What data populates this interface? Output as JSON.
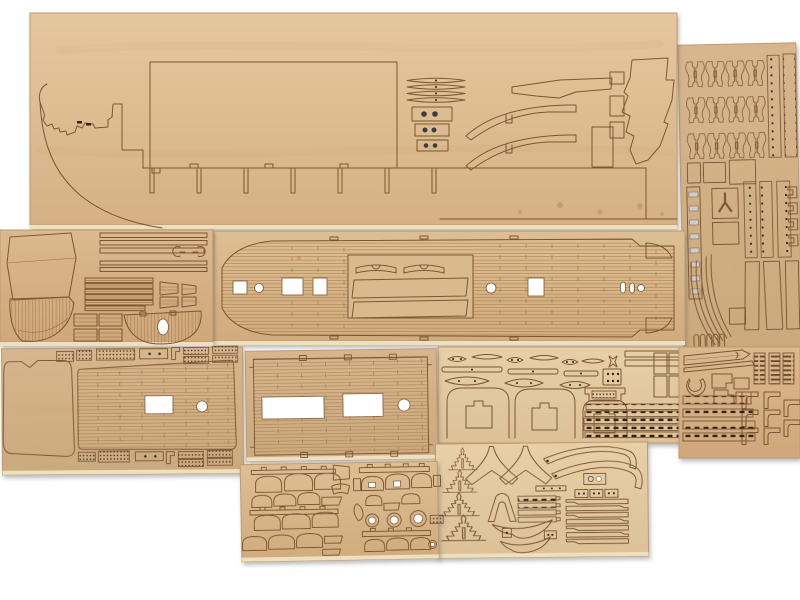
{
  "scene": {
    "title": "Laser-cut wooden model ship kit — plywood part sheets on white background",
    "subject": "photograph of tan plywood sheets with laser-cut and engraved ship parts"
  },
  "colors": {
    "bg": "#ffffff",
    "laser": "#7d5733",
    "laser-soft": "#9b6f3f",
    "plank": "#a57a49",
    "hole": "#30241a",
    "metal": "#c9ced2",
    "metal-dark": "#8e959b",
    "ply-edge": "#eedfbd",
    "sheet-edge": "#bf9a6e",
    "scorch": "#b4552d",
    "wood-flat": "#d9ba8e",
    "w1a": "#e5c79d",
    "w1b": "#d5b185",
    "w2a": "#ddbf93",
    "w2b": "#d0ab7d",
    "w3a": "#dbb88f",
    "w3b": "#cfa77a",
    "w4a": "#d8b68d",
    "w4b": "#cba97e",
    "w5a": "#e7cfa7",
    "w5b": "#dcc197"
  },
  "sheets": [
    {
      "id": "fittings-column",
      "label": "Tall right sheet with three rows of cannon-carriage brackets, drilled strips, eyebolt strip, curved battens and trapezoid parts",
      "carriage_rows": 3,
      "carriages_per_row": 4
    },
    {
      "id": "hull-sides",
      "label": "Large top sheet with hull side profile, stem pieces, large rectangular cutout, bulkhead slots and stern profile parts",
      "bulkhead_slots": 7
    },
    {
      "id": "main-deck",
      "label": "Long planked main deck with mast holes, hatch openings and transom plank panel"
    },
    {
      "id": "stern-parts",
      "label": "Left sheet with stern counter panels, planked fan filler, yards with fork ends and half-round planked platform"
    },
    {
      "id": "fittings-mid",
      "label": "Middle sheet with three companionway hoods, deadeye link plates, drilled plate and six slotted ladder strips",
      "hoods": 3,
      "ladder_strips": 6
    },
    {
      "id": "fittings-right",
      "label": "Lower right sheet with three ladders, davit brackets, slotted channels and pointed battens",
      "ladders": 3
    },
    {
      "id": "fore-deck",
      "label": "Lower left sheet with bow deck blank, planked tapered foredeck, grating strips top and bottom"
    },
    {
      "id": "mid-deck",
      "label": "Planked midship deck panel with two rectangular hatch openings and one round mast hole",
      "hatches": 2
    },
    {
      "id": "mast-parts",
      "label": "Bottom right sheet with stepped mast tops, curved knees, notched battens and V-shaped crutches",
      "mast_tops": 4,
      "notched_bars": 7
    },
    {
      "id": "boat-frames",
      "label": "Bottom sheet with ship's boat frames, pegged rails, three mast rings and small wedges",
      "mast_rings": 3
    }
  ]
}
